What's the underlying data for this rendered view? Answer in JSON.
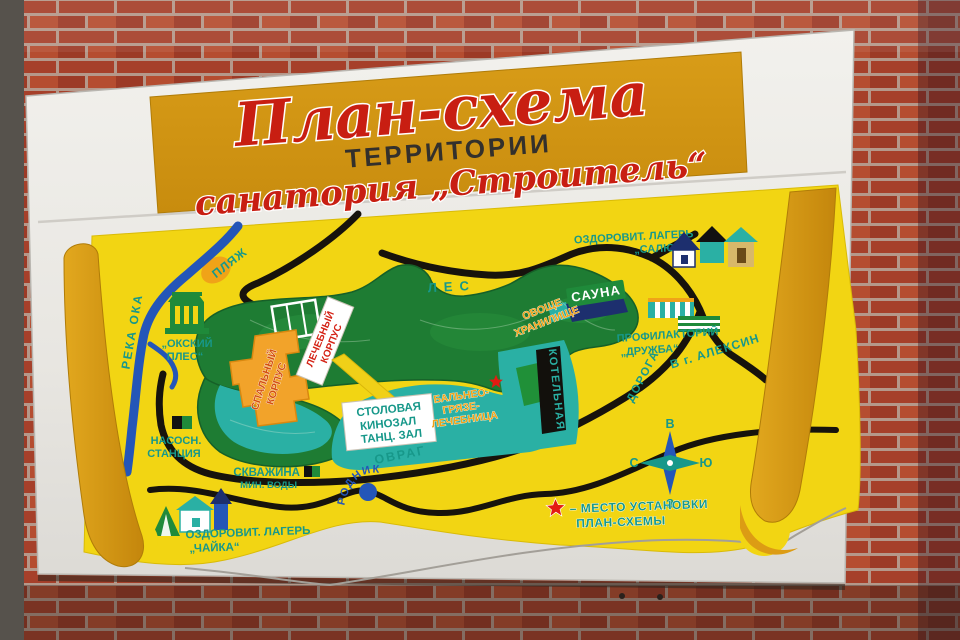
{
  "banner": {
    "line1": "План-схема",
    "line2": "ТЕРРИТОРИИ",
    "line3": "санатория „Строитель“"
  },
  "map": {
    "river": {
      "label": "РЕКА ОКА"
    },
    "beach": {
      "label": "ПЛЯЖ"
    },
    "oksky_ples": {
      "line1": "„ОКСКИЙ",
      "line2": "ПЛЕС“"
    },
    "pump_station": {
      "line1": "НАСОСН.",
      "line2": "СТАНЦИЯ"
    },
    "camp_chayka": {
      "line1": "ОЗДОРОВИТ. ЛАГЕРЬ",
      "line2": "„ЧАЙКА“"
    },
    "well": {
      "line1": "СКВАЖИНА",
      "line2": "МИН. ВОДЫ"
    },
    "spring": {
      "label": "РОДНИК"
    },
    "ravine": {
      "label": "ОВРАГ"
    },
    "forest": {
      "label": "ЛЕС"
    },
    "dorm": {
      "line1": "СПАЛЬНЫЙ",
      "line2": "КОРПУС"
    },
    "medical": {
      "line1": "ЛЕЧЕБНЫЙ",
      "line2": "КОРПУС"
    },
    "canteen": {
      "line1": "СТОЛОВАЯ",
      "line2": "КИНОЗАЛ",
      "line3": "ТАНЦ. ЗАЛ"
    },
    "balneo": {
      "line1": "БАЛЬНЕО-",
      "line2": "ГРЯЗЕ-",
      "line3": "ЛЕЧЕБНИЦА"
    },
    "boiler": {
      "label": "КОТЕЛЬНАЯ"
    },
    "sauna": {
      "label": "САУНА"
    },
    "veg_store": {
      "line1": "ОВОЩЕ",
      "line2": "ХРАНИЛИЩЕ"
    },
    "camp_salut": {
      "line1": "ОЗДОРОВИТ. ЛАГЕРЬ",
      "line2": "„САЛЮТ“"
    },
    "profilactory": {
      "line1": "ПРОФИЛАКТОРИЙ",
      "line2": "„ДРУЖБА“"
    },
    "road": {
      "label": "ДОРОГА"
    },
    "to_aleksin": {
      "label": "В г. АЛЕКСИН"
    }
  },
  "legend": {
    "line1": "– МЕСТО УСТАНОВКИ",
    "line2": "ПЛАН-СХЕМЫ"
  },
  "compass": {
    "top": "В",
    "left": "С",
    "right": "Ю",
    "bottom": "З"
  },
  "colors": {
    "panel_yellow": "#f2d513",
    "banner_amber": "#cf9415",
    "pillar_amber": "#dc9c14",
    "teal_label": "#17988a",
    "teal_area": "#2ab0a4",
    "forest_green": "#1e7c33",
    "road_black": "#17130c",
    "river_blue": "#2456b8",
    "building_orange": "#f2a32a",
    "title_red": "#c81e12",
    "star_red": "#e31b12",
    "brick_red": "#a6402a",
    "board_white": "#edebe6"
  }
}
